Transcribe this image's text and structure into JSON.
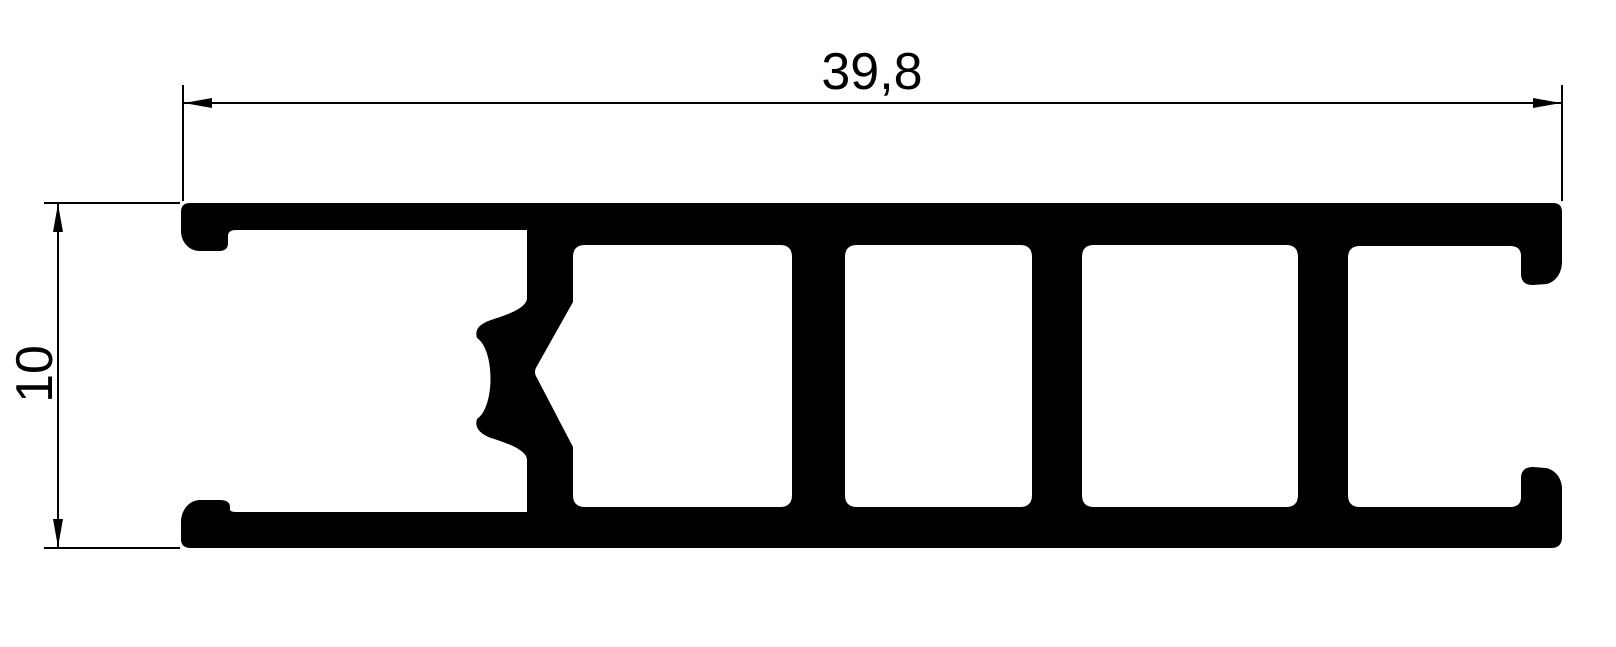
{
  "page": {
    "background_color": "#ffffff"
  },
  "drawing": {
    "kind": "aluminium-extrusion-profile-cross-section",
    "profile_color": "#000000",
    "dimension_line_color": "#000000",
    "width_dimension": {
      "value": "39,8"
    },
    "height_dimension": {
      "value": "10"
    }
  }
}
